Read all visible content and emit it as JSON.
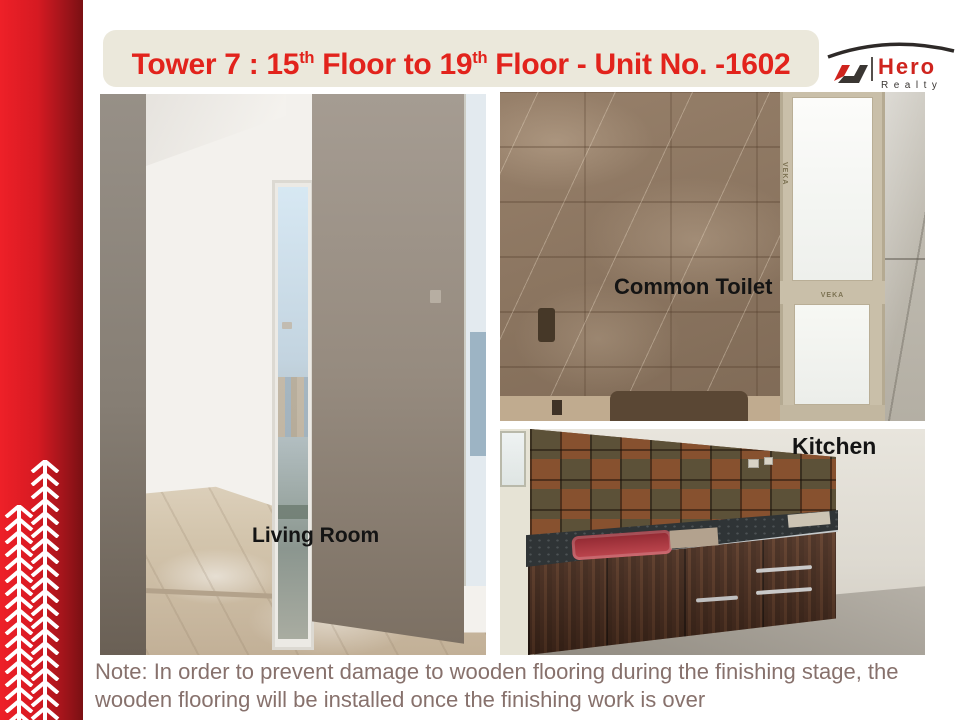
{
  "slide": {
    "title": {
      "part1": "Tower 7 : 15",
      "sup1": "th",
      "part2": " Floor to 19",
      "sup2": "th",
      "part3": " Floor - Unit No. -1602"
    },
    "logo": {
      "brand": "Hero",
      "tagline": "Realty"
    },
    "photos": {
      "living_room": {
        "label": "Living Room"
      },
      "common_toilet": {
        "label": "Common Toilet",
        "window_brand": "VEKA"
      },
      "kitchen": {
        "label": "Kitchen"
      }
    },
    "note": "Note: In order to prevent damage to wooden flooring during the finishing stage, the wooden flooring will be installed once the finishing work is over"
  },
  "colors": {
    "accent_red": "#e2231c",
    "sidebar_red_light": "#ee2028",
    "sidebar_red_dark": "#7a1013",
    "title_banner_bg": "#ebe8db",
    "note_text": "#87716c",
    "photo_label_text": "#141414",
    "logo_brand_red": "#cf241e",
    "logo_dark": "#3a3633"
  }
}
